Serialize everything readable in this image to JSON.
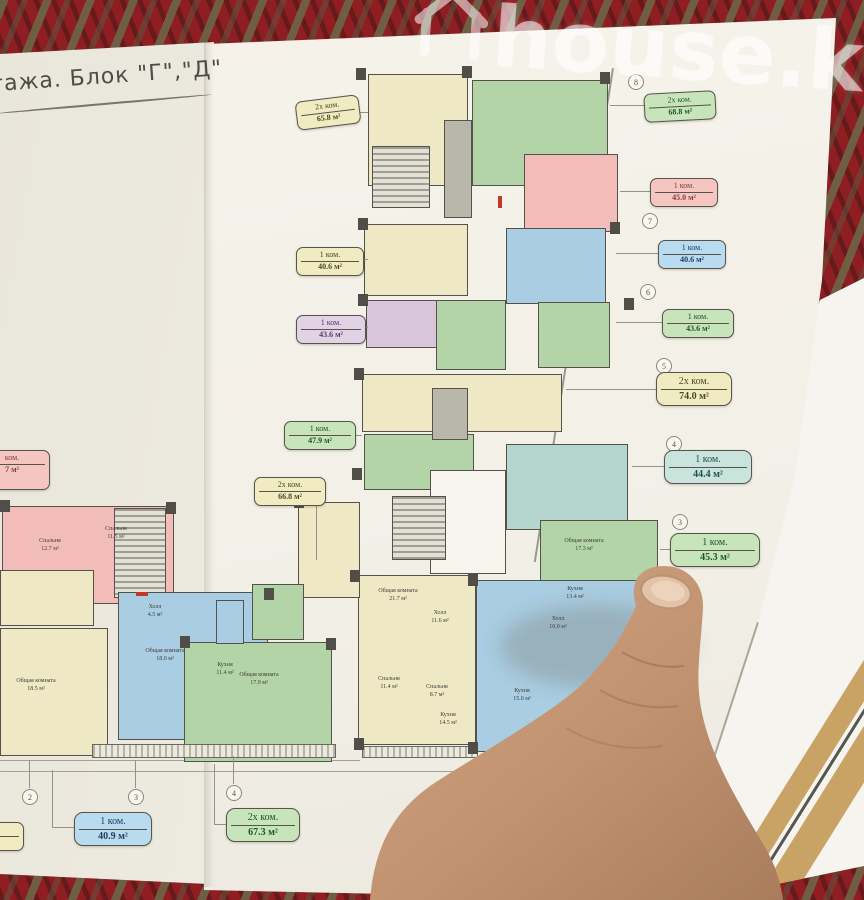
{
  "watermark": {
    "text": "house.kg",
    "icon": "house-outline-icon"
  },
  "page": {
    "title": "тажа. Блок \"Г\",\"Д\""
  },
  "floor_plan": {
    "unit_badges": [
      {
        "rooms": "2х ком.",
        "area": "65.8 м²",
        "color": "yellow"
      },
      {
        "rooms": "1 ком.",
        "area": "40.6 м²",
        "color": "yellow"
      },
      {
        "rooms": "1 ком.",
        "area": "43.6 м²",
        "color": "purple"
      },
      {
        "rooms": "1 ком.",
        "area": "47.9 м²",
        "color": "green"
      },
      {
        "rooms": "ком.",
        "area": "7 м²",
        "color": "pink"
      },
      {
        "rooms": "2х ком.",
        "area": "66.8 м²",
        "color": "yellow"
      },
      {
        "rooms": "2х ком.",
        "area": "68.8 м²",
        "color": "green"
      },
      {
        "rooms": "1 ком.",
        "area": "45.0 м²",
        "color": "pink"
      },
      {
        "rooms": "1 ком.",
        "area": "40.6 м²",
        "color": "blue"
      },
      {
        "rooms": "1 ком.",
        "area": "43.6 м²",
        "color": "green"
      },
      {
        "rooms": "2х ком.",
        "area": "74.0 м²",
        "color": "yellow"
      },
      {
        "rooms": "1 ком.",
        "area": "44.4 м²",
        "color": "teal"
      },
      {
        "rooms": "1 ком.",
        "area": "45.3 м²",
        "color": "green"
      },
      {
        "rooms": "1 ком.",
        "area": "40.9 м²",
        "color": "blue"
      },
      {
        "rooms": "2х ком.",
        "area": "67.3 м²",
        "color": "green"
      },
      {
        "rooms": "ком.",
        "area": "м²",
        "color": "yellow"
      }
    ],
    "axis_right": [
      "8",
      "7",
      "6",
      "5",
      "4",
      "3"
    ],
    "axis_bottom": [
      "2",
      "3",
      "4"
    ],
    "rooms": [
      {
        "name": "Общая комната",
        "area": "21.7 м²"
      },
      {
        "name": "Холл",
        "area": "11.6 м²"
      },
      {
        "name": "Спальня",
        "area": "11.4 м²"
      },
      {
        "name": "Спальня",
        "area": "8.7 м²"
      },
      {
        "name": "Кухня",
        "area": "14.5 м²"
      },
      {
        "name": "Холл",
        "area": "10.0 м²"
      },
      {
        "name": "Кухня",
        "area": "15.0 м²"
      },
      {
        "name": "Спальня",
        "area": "14.3 м²"
      },
      {
        "name": "Общая комната",
        "area": "18.1 м²"
      },
      {
        "name": "Общая комната",
        "area": "17.3 м²"
      },
      {
        "name": "Кухня",
        "area": "13.4 м²"
      },
      {
        "name": "Спальня",
        "area": "12.7 м²"
      },
      {
        "name": "Спальня",
        "area": "11.5 м²"
      },
      {
        "name": "Общая комната",
        "area": "18.0 м²"
      },
      {
        "name": "Кухня",
        "area": "11.4 м²"
      },
      {
        "name": "Холл",
        "area": "4.5 м²"
      },
      {
        "name": "Общая комната",
        "area": "17.9 м²"
      },
      {
        "name": "Общая комната",
        "area": "18.5 м²"
      }
    ]
  }
}
